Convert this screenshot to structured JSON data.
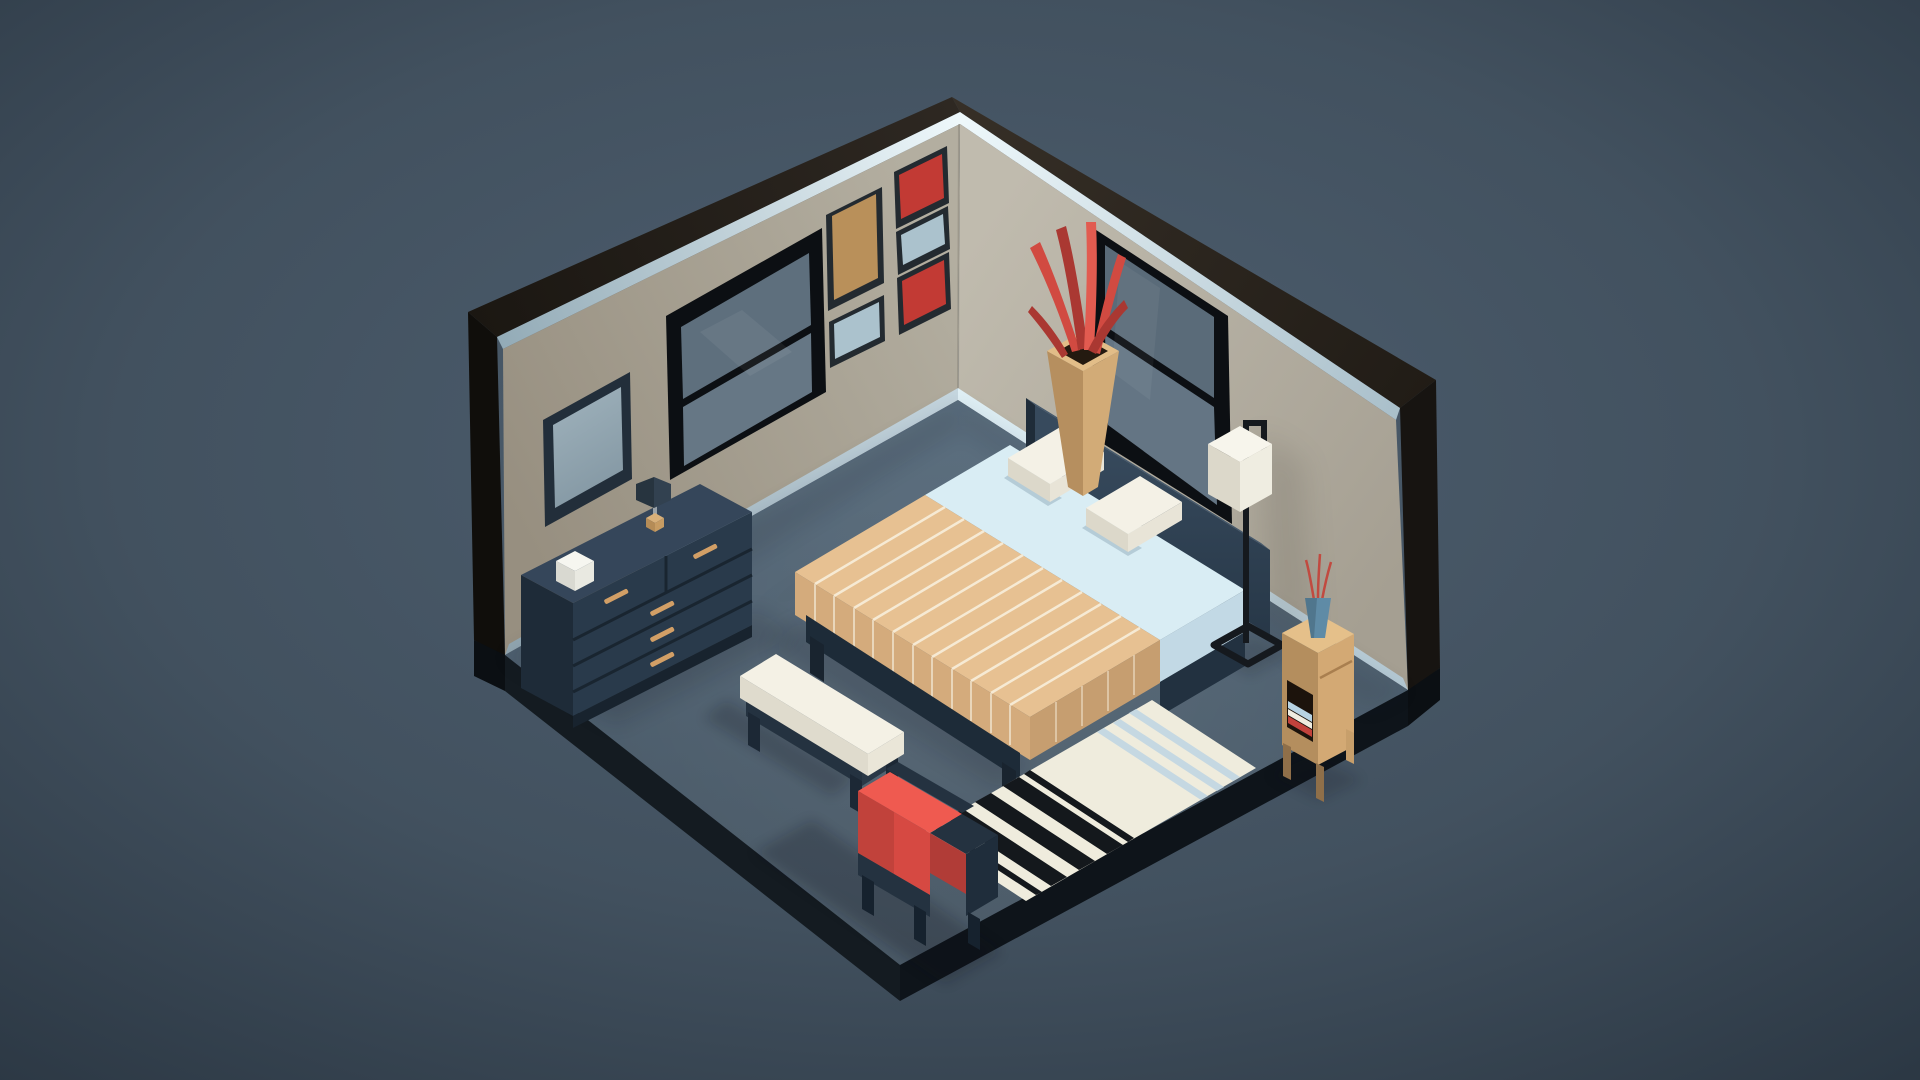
{
  "canvas": {
    "width": 1920,
    "height": 1080
  },
  "scene": {
    "description": "Low-poly isometric 3D bedroom render on slate-blue backdrop",
    "objects": [
      "room-shell",
      "left-wall-mirror",
      "left-wall-window",
      "wall-art-frames",
      "right-wall-window",
      "dresser",
      "dresser-table-lamp",
      "white-box",
      "bed",
      "pillows",
      "striped-blanket",
      "bench",
      "striped-rug",
      "red-armchair",
      "floor-lamp",
      "nightstand",
      "books",
      "corner-plant-vase"
    ]
  },
  "palette": {
    "bg_center": "#4e5f70",
    "bg_mid": "#42515f",
    "bg_edge": "#2b3743",
    "roof_left_a": "#2e2822",
    "roof_left_b": "#1b1712",
    "roof_right_a": "#362f27",
    "roof_right_b": "#211c16",
    "cap_left": "#100e0b",
    "cap_right": "#171411",
    "trim_bright": "#eef8fb",
    "trim_left_dim": "#93abb7",
    "trim_right_dim": "#a9bfca",
    "wall_left_a": "#b3aea0",
    "wall_left_b": "#978f80",
    "wall_right_a": "#c0bbae",
    "wall_right_b": "#a59f92",
    "baseboard_left_a": "#c6d7e0",
    "baseboard_left_b": "#90a5b0",
    "baseboard_right_a": "#e0f0f6",
    "baseboard_right_b": "#b4c9d4",
    "floor_a": "#546879",
    "floor_b": "#475663",
    "slab_left": "#141b21",
    "slab_right": "#0e141a",
    "slab_step": "#0b0f13",
    "shadow": "#0b1118",
    "wall_shadow": "#3e3a32",
    "frame_dark": "#222e3a",
    "mirror_glass_a": "#9db0ba",
    "mirror_glass_b": "#8195a1",
    "window_frame": "#0c0f13",
    "glass_upper": "#5e6f7d",
    "glass_lower": "#667785",
    "glass_upper_r": "#5a6b79",
    "glass_lower_r": "#647584",
    "art_tan": "#b9905a",
    "art_red": "#c23a34",
    "art_blue": "#abc2cd",
    "art_frame": "#232a30",
    "dresser_top": "#35465a",
    "dresser_front": "#293a4b",
    "dresser_side": "#1e2b38",
    "dresser_plinth": "#18232e",
    "handle": "#d29f66",
    "tlamp_shade_l": "#27343f",
    "tlamp_shade_r": "#324150",
    "tlamp_base_a": "#d8b07a",
    "tlamp_base_b": "#b58c57",
    "tlamp_base_c": "#c79c63",
    "box_top": "#f6f6f0",
    "box_left": "#d9d9d1",
    "box_right": "#e9e9e1",
    "hb_top": "#44586c",
    "hb_face_a": "#374a5d",
    "hb_face_b": "#263646",
    "hb_cap": "#1f2c39",
    "sheet": "#d9edf4",
    "sheet_side": "#c2d9e5",
    "pillow_top": "#f4f1e6",
    "pillow_left": "#dcd8ca",
    "pillow_right": "#e8e4d7",
    "blanket_top": "#e7c192",
    "blanket_foot": "#d4ab7c",
    "blanket_drape": "#c69e70",
    "blanket_stripe": "#f6ead4",
    "blanket_stripe_side": "#e9d6ba",
    "bedframe": "#1d2b38",
    "bedframe_side": "#223140",
    "bedframe_leg": "#19242f",
    "bench_top": "#f4f1e5",
    "bench_front": "#dfdbcd",
    "bench_cap": "#eae6d8",
    "bench_frame": "#243240",
    "bench_frame2": "#2a3846",
    "bench_leg": "#1c2835",
    "rug_base": "#efecdd",
    "rug_black": "#14181c",
    "rug_blue": "#c5d8e2",
    "chair_red_top": "#ef5a50",
    "chair_red_face": "#d64942",
    "chair_red_dark": "#b13c37",
    "chair_frame": "#243240",
    "chair_frame_dark": "#1f2d3b",
    "chair_leg": "#16222e",
    "flamp_metal": "#15191e",
    "flamp_shade_top": "#f7f5ec",
    "flamp_shade_r": "#efede1",
    "flamp_shade_l": "#dcd8ca",
    "ns_top": "#e5c08a",
    "ns_right": "#d3a974",
    "ns_left": "#b48e5e",
    "ns_leg_d": "#8f6f49",
    "ns_leg_l": "#c79f6b",
    "ns_shelf": "#1c130c",
    "book_blue": "#b7d3e3",
    "book_white": "#efece0",
    "book_red": "#c2423c",
    "ns_vase": "#5f8ba6",
    "sprig": "#c14a40",
    "vase_left": "#b68f5f",
    "vase_right": "#d2ab77",
    "vase_rim": "#e2bd88",
    "vase_hole": "#241a10",
    "leaf_a": "#d14a41",
    "leaf_b": "#aa3832",
    "leaf_c": "#e25b50",
    "glass_streak": "#ffffff"
  }
}
